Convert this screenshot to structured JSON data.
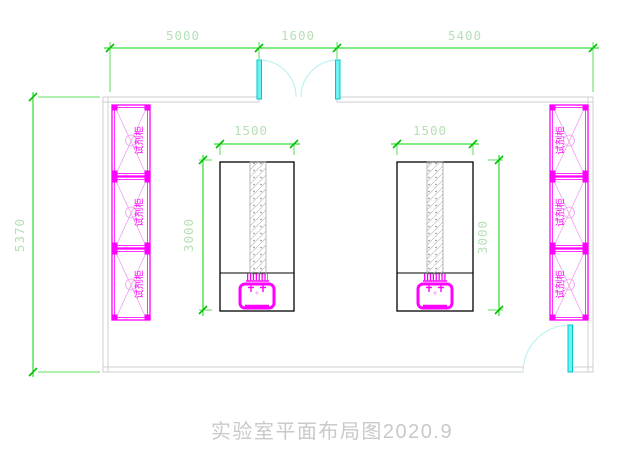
{
  "title": "实验室平面布局图2020.9",
  "dims": {
    "top_left": "5000",
    "top_mid": "1600",
    "top_right": "5400",
    "left_height": "5370",
    "bench_width": "1500",
    "bench_depth": "3000"
  },
  "cabinet": {
    "label": "试剂柜"
  },
  "colors": {
    "dimension_line": "#00d400",
    "dimension_text": "#b7dfb7",
    "cabinet": "#ff00ff",
    "door": "#00c8c8",
    "wall": "#cfcfcf",
    "bench_outline": "#000000",
    "title_text": "#c9c9c9"
  }
}
